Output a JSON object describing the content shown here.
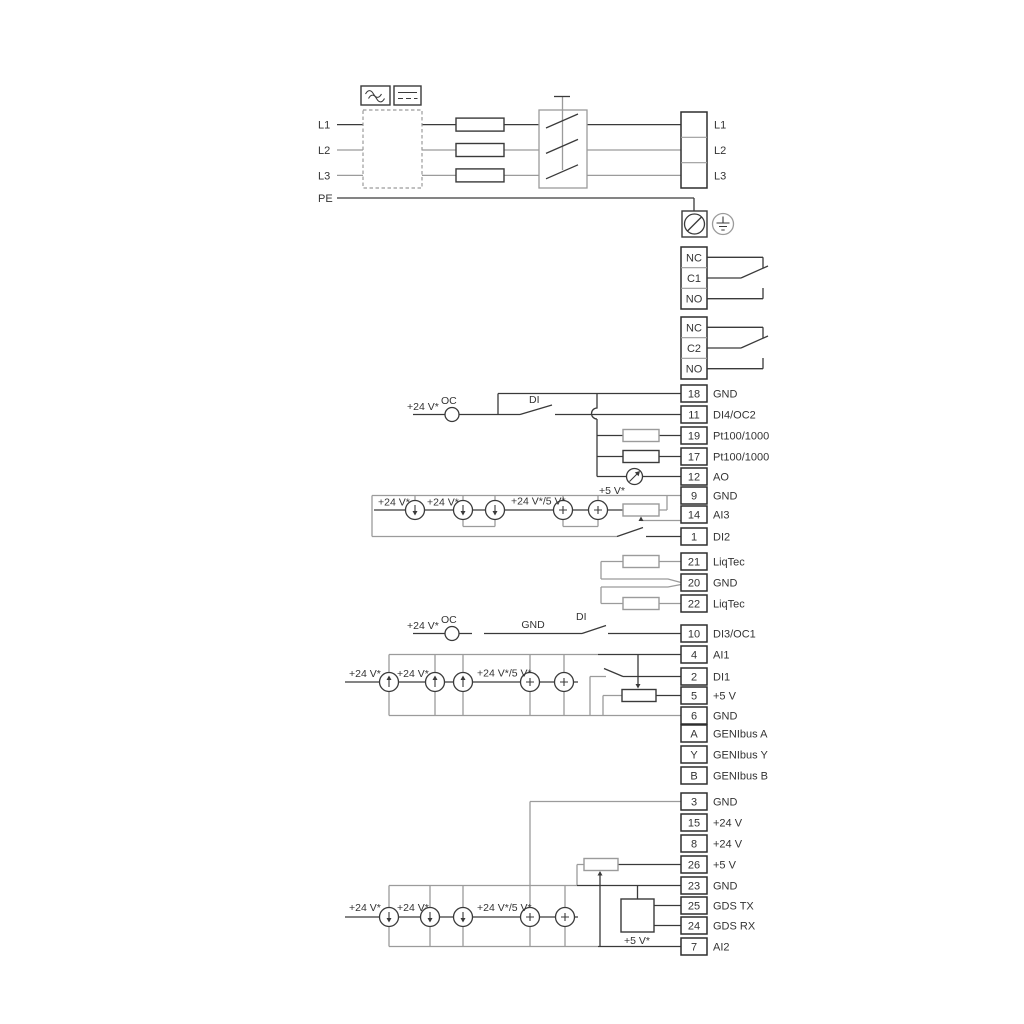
{
  "power": {
    "inputs": [
      "L1",
      "L2",
      "L3",
      "PE"
    ],
    "outputs": [
      "L1",
      "L2",
      "L3"
    ]
  },
  "relays": {
    "r1": [
      "NC",
      "C1",
      "NO"
    ],
    "r2": [
      "NC",
      "C2",
      "NO"
    ]
  },
  "labels": {
    "v24": "+24 V*",
    "v24_5": "+24 V*/5 V*",
    "v5": "+5 V*",
    "oc": "OC",
    "di": "DI",
    "gnd": "GND"
  },
  "terminals": {
    "g1": [
      {
        "num": "18",
        "label": "GND"
      },
      {
        "num": "11",
        "label": "DI4/OC2"
      },
      {
        "num": "19",
        "label": "Pt100/1000"
      },
      {
        "num": "17",
        "label": "Pt100/1000"
      },
      {
        "num": "12",
        "label": "AO"
      },
      {
        "num": "9",
        "label": "GND"
      },
      {
        "num": "14",
        "label": "AI3"
      },
      {
        "num": "1",
        "label": "DI2"
      }
    ],
    "g2": [
      {
        "num": "21",
        "label": "LiqTec"
      },
      {
        "num": "20",
        "label": "GND"
      },
      {
        "num": "22",
        "label": "LiqTec"
      }
    ],
    "g3": [
      {
        "num": "10",
        "label": "DI3/OC1"
      },
      {
        "num": "4",
        "label": "AI1"
      },
      {
        "num": "2",
        "label": "DI1"
      },
      {
        "num": "5",
        "label": "+5 V"
      },
      {
        "num": "6",
        "label": "GND"
      },
      {
        "num": "A",
        "label": "GENIbus A"
      },
      {
        "num": "Y",
        "label": "GENIbus Y"
      },
      {
        "num": "B",
        "label": "GENIbus B"
      }
    ],
    "g4": [
      {
        "num": "3",
        "label": "GND"
      },
      {
        "num": "15",
        "label": "+24 V"
      },
      {
        "num": "8",
        "label": "+24 V"
      },
      {
        "num": "26",
        "label": "+5 V"
      },
      {
        "num": "23",
        "label": "GND"
      },
      {
        "num": "25",
        "label": "GDS TX"
      },
      {
        "num": "24",
        "label": "GDS RX"
      },
      {
        "num": "7",
        "label": "AI2"
      }
    ]
  },
  "colors": {
    "wire_gray": "#9b9b9b",
    "wire_dark": "#3a3a3a",
    "text": "#333333",
    "background": "#ffffff"
  }
}
